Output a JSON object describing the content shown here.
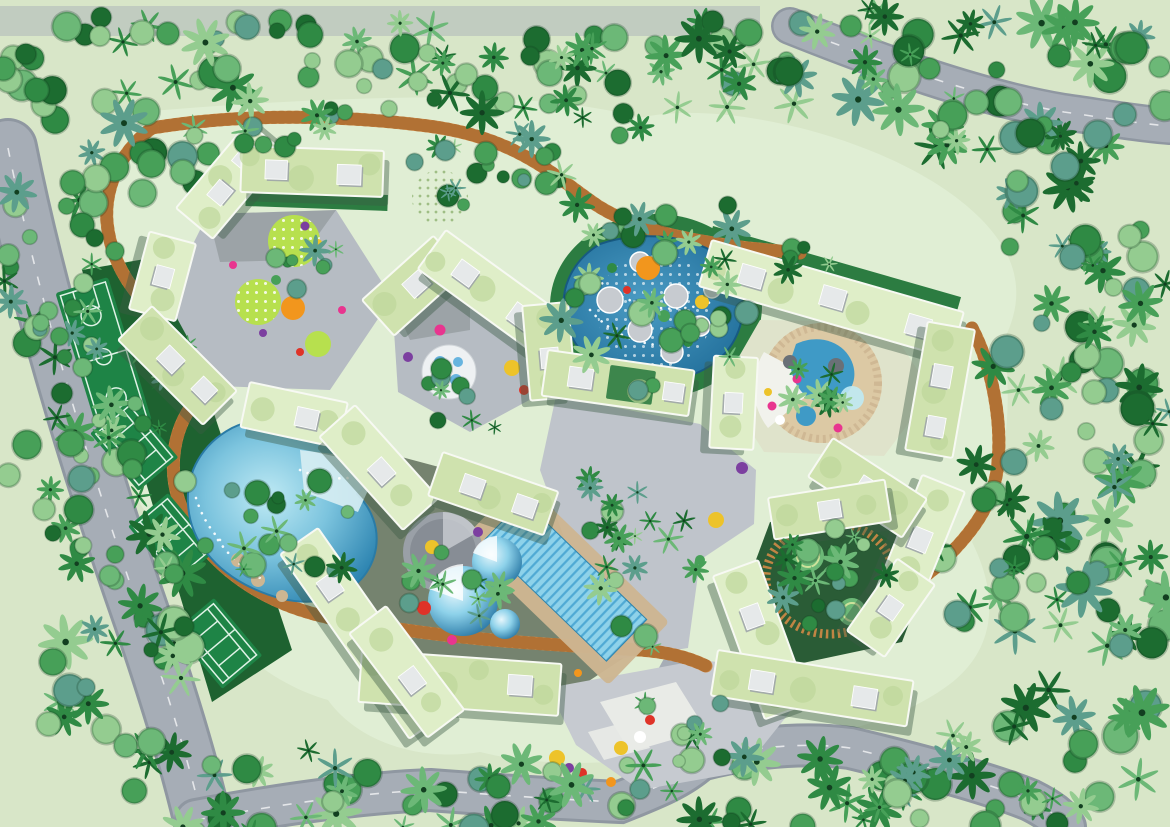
{
  "scene": {
    "kind": "architectural-site-plan-aerial-rendering",
    "counts": {
      "tennis_courts": 3,
      "basketball_courts": 1,
      "hexagonal_courtyard_clusters": 5,
      "building_bars": 22,
      "swimming_pools": 4,
      "water_gardens": 2
    },
    "amenities": [
      "basketball-court",
      "tennis-courts",
      "lagoon-pool",
      "lap-pool",
      "kids-dome-pools",
      "water-garden-pond",
      "circular-water-feature",
      "playground-circles",
      "boardwalk-loop",
      "central-plaza",
      "perimeter-roads",
      "dense-tropical-forest"
    ]
  },
  "palette": {
    "ground": "#d8e6c8",
    "site": "#e0eed4",
    "road": "#a6adb6",
    "road_edge": "#8f97a1",
    "lane": "#eef0f2",
    "plaza": "#bfc4cb",
    "plaza2": "#c6cad0",
    "plaza_white": "#e9ebe7",
    "paving": "#b6bcc3",
    "floor_dark": "#75836f",
    "floor_e": "#2a5c36",
    "floor_d": "#dfe3cb",
    "lawn": "#2c7c41",
    "lawn_dark": "#1e6230",
    "court": "#1e8446",
    "court_line": "#dff2e6",
    "roof": "#cfe2ae",
    "roof_light": "#dfeec8",
    "roof_circle": "#bdd79a",
    "roof_edge": "#f7f9f3",
    "bshadow": "#3c5a44",
    "box": "#e6e9ea",
    "box_shadow": "#9ba1a8",
    "boardwalk": "#d08a46",
    "boardwalk_dark": "#a96a2f",
    "tan": "#cdb692",
    "sand": "#dcc9a4",
    "pool_deep": "#1f6f9e",
    "pool_mid": "#3f9ac6",
    "pool_light": "#bfeaf4",
    "lap": "#8ed2ea",
    "lap_stripe": "#4fa9d4",
    "lime": "#b7e04e",
    "gray_circle": "#8e939b",
    "accent_orange": "#f2961d",
    "accent_red": "#df3328",
    "accent_magenta": "#e8358f",
    "accent_purple": "#7c3fa0",
    "accent_yellow": "#edc32a",
    "accent_blue": "#3a9fd8",
    "t0": "#1c6c30",
    "t1": "#2f8a44",
    "t2": "#47a058",
    "t3": "#6cb877",
    "t4": "#94cc90",
    "t5": "#5c9e8c"
  },
  "vegetation": {
    "fields": [
      "x",
      "y",
      "rx",
      "ry",
      "count",
      "scale_min",
      "scale_max",
      "palm_ratio",
      "fern_ratio",
      "layer"
    ],
    "clusters": [
      [
        115,
        110,
        125,
        95,
        38,
        0.8,
        1.6,
        0.15,
        0.1,
        "back"
      ],
      [
        330,
        62,
        150,
        55,
        34,
        0.7,
        1.5,
        0.2,
        0.15,
        "back"
      ],
      [
        565,
        80,
        130,
        62,
        30,
        0.7,
        1.4,
        0.25,
        0.2,
        "back"
      ],
      [
        800,
        58,
        150,
        58,
        34,
        0.8,
        1.6,
        0.3,
        0.2,
        "back"
      ],
      [
        1030,
        85,
        140,
        85,
        40,
        0.8,
        1.7,
        0.3,
        0.25,
        "back"
      ],
      [
        1090,
        235,
        85,
        110,
        30,
        0.8,
        1.6,
        0.2,
        0.2,
        "back"
      ],
      [
        1070,
        425,
        100,
        120,
        36,
        0.8,
        1.7,
        0.25,
        0.2,
        "back"
      ],
      [
        1080,
        635,
        95,
        120,
        34,
        0.9,
        1.8,
        0.3,
        0.2,
        "back"
      ],
      [
        1000,
        775,
        160,
        55,
        28,
        0.8,
        1.6,
        0.35,
        0.2,
        "back"
      ],
      [
        760,
        792,
        180,
        42,
        26,
        0.8,
        1.5,
        0.3,
        0.25,
        "back"
      ],
      [
        480,
        800,
        160,
        38,
        22,
        0.8,
        1.6,
        0.35,
        0.2,
        "back"
      ],
      [
        225,
        788,
        140,
        48,
        20,
        0.8,
        1.5,
        0.25,
        0.2,
        "back"
      ],
      [
        112,
        645,
        85,
        135,
        32,
        0.8,
        1.7,
        0.25,
        0.2,
        "back"
      ],
      [
        70,
        430,
        68,
        120,
        28,
        0.7,
        1.5,
        0.2,
        0.2,
        "back"
      ],
      [
        58,
        252,
        62,
        92,
        22,
        0.7,
        1.4,
        0.2,
        0.15,
        "back"
      ],
      [
        165,
        500,
        55,
        175,
        18,
        0.6,
        1.2,
        0.2,
        0.3,
        "back"
      ],
      [
        985,
        560,
        55,
        70,
        14,
        0.8,
        1.5,
        0.3,
        0.2,
        "back"
      ],
      [
        655,
        215,
        95,
        30,
        12,
        0.7,
        1.3,
        0.25,
        0.2,
        "back"
      ],
      [
        480,
        168,
        85,
        42,
        20,
        0.6,
        1.2,
        0.15,
        0.3,
        "front"
      ],
      [
        658,
        312,
        98,
        82,
        22,
        0.7,
        1.4,
        0.2,
        0.2,
        "front"
      ],
      [
        302,
        256,
        52,
        42,
        8,
        0.5,
        1.0,
        0.1,
        0.2,
        "front"
      ],
      [
        288,
        532,
        72,
        72,
        18,
        0.6,
        1.3,
        0.2,
        0.3,
        "front"
      ],
      [
        458,
        398,
        52,
        42,
        9,
        0.5,
        1.1,
        0.2,
        0.3,
        "front"
      ],
      [
        452,
        592,
        52,
        52,
        12,
        0.6,
        1.2,
        0.25,
        0.3,
        "front"
      ],
      [
        832,
        578,
        56,
        50,
        18,
        0.6,
        1.2,
        0.2,
        0.25,
        "front"
      ],
      [
        822,
        384,
        40,
        33,
        8,
        0.5,
        0.95,
        0.6,
        0.2,
        "front"
      ],
      [
        652,
        560,
        55,
        88,
        14,
        0.6,
        1.2,
        0.3,
        0.3,
        "front"
      ],
      [
        682,
        732,
        68,
        38,
        10,
        0.6,
        1.1,
        0.3,
        0.3,
        "front"
      ],
      [
        602,
        520,
        38,
        48,
        7,
        0.5,
        1.0,
        0.4,
        0.2,
        "front"
      ],
      [
        305,
        130,
        115,
        22,
        9,
        0.6,
        1.1,
        0.2,
        0.2,
        "front"
      ],
      [
        760,
        262,
        70,
        20,
        7,
        0.6,
        1.0,
        0.3,
        0.2,
        "front"
      ]
    ]
  }
}
